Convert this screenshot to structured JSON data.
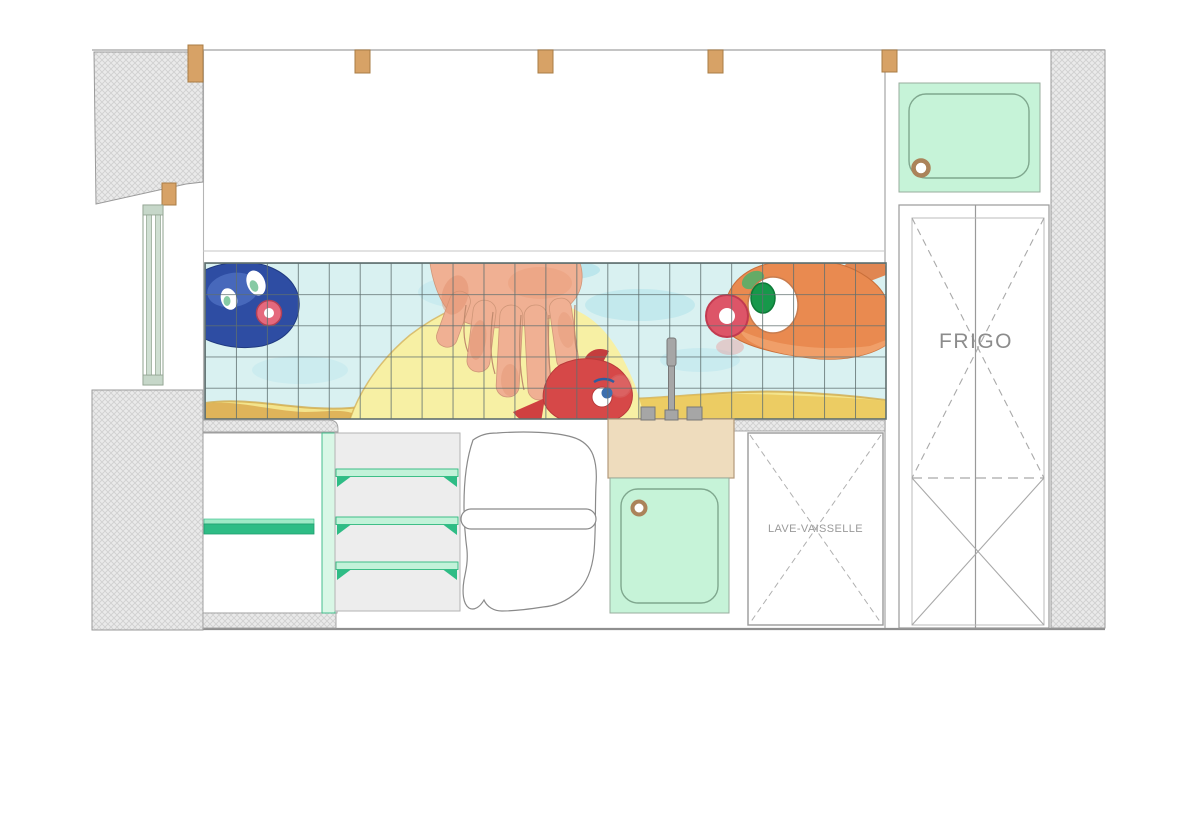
{
  "labels": {
    "fridge": "FRIGO",
    "dishwasher": "LAVE-VAISSELLE"
  },
  "colors": {
    "wood_beam": "#d7a266",
    "wood_beam_edge": "#a87c45",
    "mint_fixture": "#c6f3d8",
    "divider_mint": "#d9f7e6",
    "shelf_green": "#2ebc85",
    "shelf_light_green": "#c2f2d9",
    "counter_tan": "#eedcbd",
    "water": "#d9f1f1",
    "sand_yellow": "#f3e48d",
    "sand_gold": "#e9c455",
    "sand_mound": "#f7f0a4",
    "hand_skin": "#f0b093",
    "fish_blue": "#2e4da3",
    "fish_red": "#d64848",
    "fish_orange": "#e98a50",
    "tile_grid": "#5f6f6f",
    "outline_gray": "#9a9a9a",
    "drain_brown": "#ab835a"
  }
}
